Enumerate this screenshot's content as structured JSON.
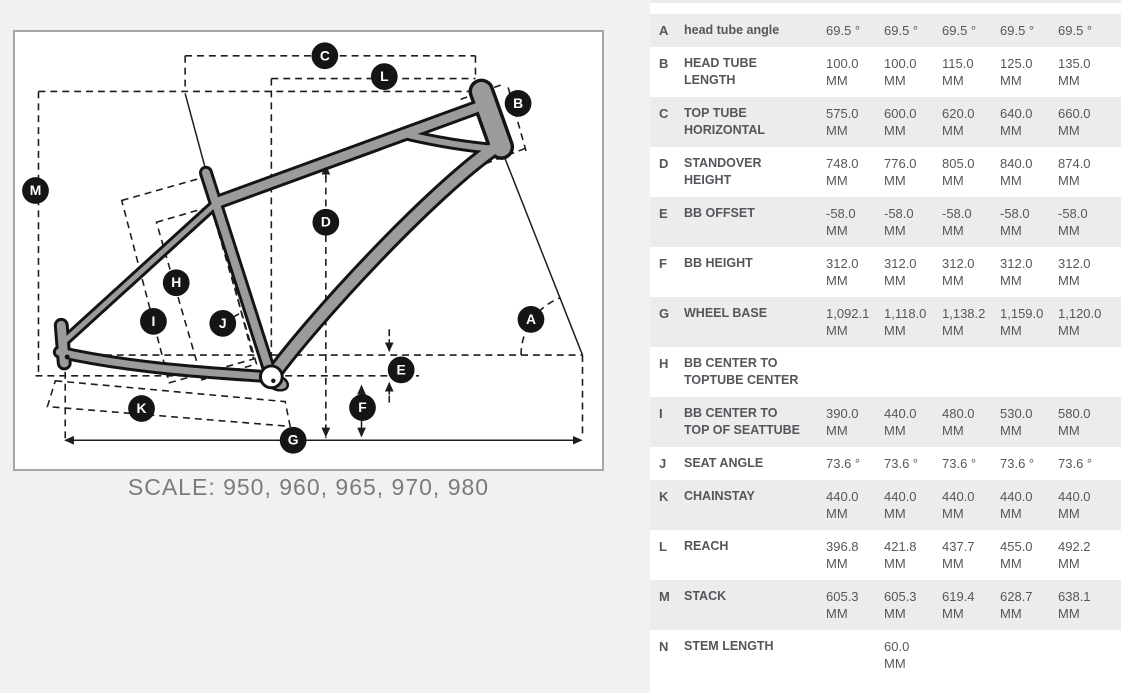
{
  "diagram": {
    "caption": "SCALE: 950, 960, 965, 970, 980",
    "labels": {
      "a": "A",
      "b": "B",
      "c": "C",
      "d": "D",
      "e": "E",
      "f": "F",
      "g": "G",
      "h": "H",
      "i": "I",
      "j": "J",
      "k": "K",
      "l": "L",
      "m": "M"
    }
  },
  "table": {
    "rows": [
      {
        "letter": "A",
        "label": "head tube angle",
        "values": [
          [
            "69.5 °"
          ],
          [
            "69.5 °"
          ],
          [
            "69.5 °"
          ],
          [
            "69.5 °"
          ],
          [
            "69.5 °"
          ]
        ]
      },
      {
        "letter": "B",
        "label": "HEAD TUBE LENGTH",
        "values": [
          [
            "100.0",
            "MM"
          ],
          [
            "100.0",
            "MM"
          ],
          [
            "115.0",
            "MM"
          ],
          [
            "125.0",
            "MM"
          ],
          [
            "135.0",
            "MM"
          ]
        ]
      },
      {
        "letter": "C",
        "label": "TOP TUBE HORIZONTAL",
        "values": [
          [
            "575.0",
            "MM"
          ],
          [
            "600.0",
            "MM"
          ],
          [
            "620.0",
            "MM"
          ],
          [
            "640.0",
            "MM"
          ],
          [
            "660.0",
            "MM"
          ]
        ]
      },
      {
        "letter": "D",
        "label": "STANDOVER HEIGHT",
        "values": [
          [
            "748.0",
            "MM"
          ],
          [
            "776.0",
            "MM"
          ],
          [
            "805.0",
            "MM"
          ],
          [
            "840.0",
            "MM"
          ],
          [
            "874.0",
            "MM"
          ]
        ]
      },
      {
        "letter": "E",
        "label": "BB OFFSET",
        "values": [
          [
            "-58.0",
            "MM"
          ],
          [
            "-58.0",
            "MM"
          ],
          [
            "-58.0",
            "MM"
          ],
          [
            "-58.0",
            "MM"
          ],
          [
            "-58.0",
            "MM"
          ]
        ]
      },
      {
        "letter": "F",
        "label": "BB HEIGHT",
        "values": [
          [
            "312.0",
            "MM"
          ],
          [
            "312.0",
            "MM"
          ],
          [
            "312.0",
            "MM"
          ],
          [
            "312.0",
            "MM"
          ],
          [
            "312.0",
            "MM"
          ]
        ]
      },
      {
        "letter": "G",
        "label": "WHEEL BASE",
        "values": [
          [
            "1,092.1",
            "MM"
          ],
          [
            "1,118.0",
            "MM"
          ],
          [
            "1,138.2",
            "MM"
          ],
          [
            "1,159.0",
            "MM"
          ],
          [
            "1,120.0",
            "MM"
          ]
        ]
      },
      {
        "letter": "H",
        "label": "BB CENTER TO TOPTUBE CENTER",
        "values": [
          [],
          [],
          [],
          [],
          []
        ]
      },
      {
        "letter": "I",
        "label": "BB CENTER TO TOP OF SEATTUBE",
        "values": [
          [
            "390.0",
            "MM"
          ],
          [
            "440.0",
            "MM"
          ],
          [
            "480.0",
            "MM"
          ],
          [
            "530.0",
            "MM"
          ],
          [
            "580.0",
            "MM"
          ]
        ]
      },
      {
        "letter": "J",
        "label": "SEAT ANGLE",
        "values": [
          [
            "73.6 °"
          ],
          [
            "73.6 °"
          ],
          [
            "73.6 °"
          ],
          [
            "73.6 °"
          ],
          [
            "73.6 °"
          ]
        ]
      },
      {
        "letter": "K",
        "label": "CHAINSTAY",
        "values": [
          [
            "440.0",
            "MM"
          ],
          [
            "440.0",
            "MM"
          ],
          [
            "440.0",
            "MM"
          ],
          [
            "440.0",
            "MM"
          ],
          [
            "440.0",
            "MM"
          ]
        ]
      },
      {
        "letter": "L",
        "label": "REACH",
        "values": [
          [
            "396.8",
            "MM"
          ],
          [
            "421.8",
            "MM"
          ],
          [
            "437.7",
            "MM"
          ],
          [
            "455.0",
            "MM"
          ],
          [
            "492.2",
            "MM"
          ]
        ]
      },
      {
        "letter": "M",
        "label": "STACK",
        "values": [
          [
            "605.3",
            "MM"
          ],
          [
            "605.3",
            "MM"
          ],
          [
            "619.4",
            "MM"
          ],
          [
            "628.7",
            "MM"
          ],
          [
            "638.1",
            "MM"
          ]
        ]
      },
      {
        "letter": "N",
        "label": "STEM LENGTH",
        "values": [
          [],
          [
            "60.0",
            "MM"
          ],
          [],
          [],
          []
        ]
      }
    ]
  }
}
